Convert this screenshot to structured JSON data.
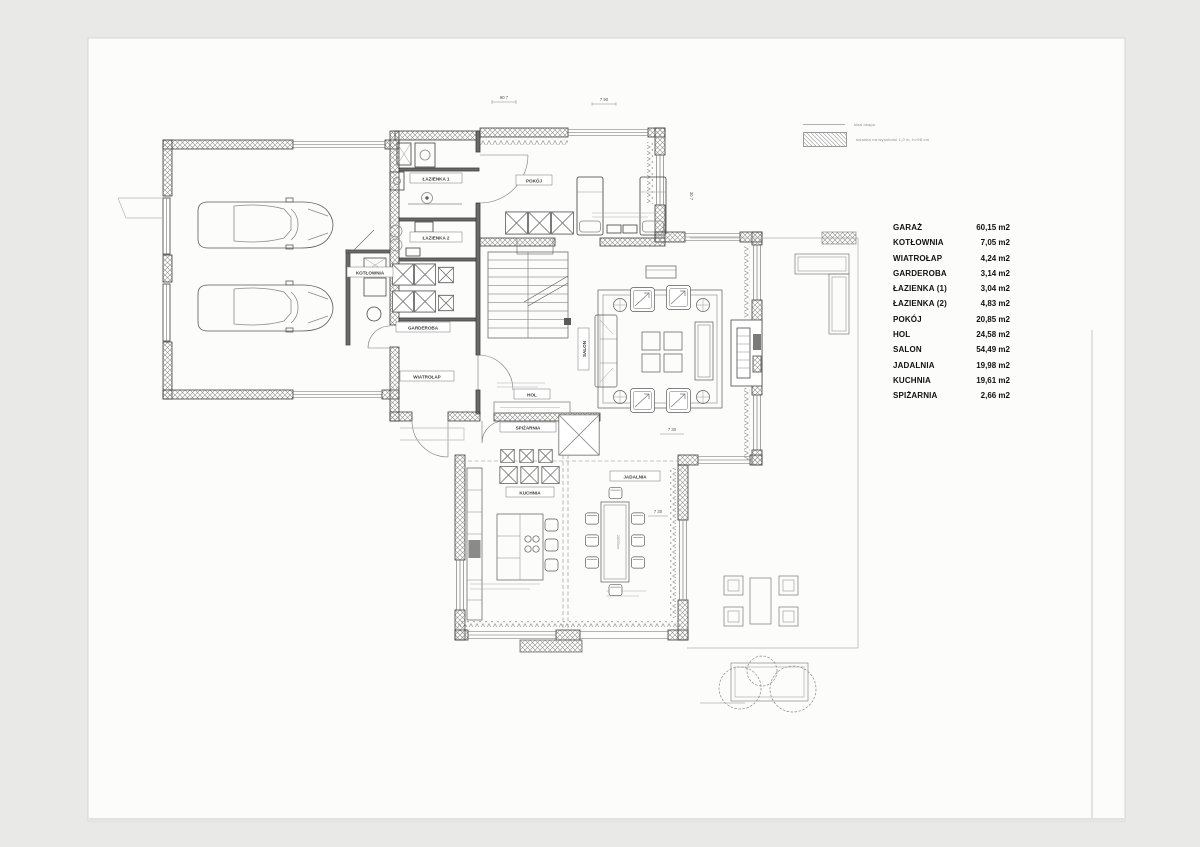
{
  "rooms": [
    {
      "name": "GARAŻ",
      "area": "60,15 m2"
    },
    {
      "name": "KOTŁOWNIA",
      "area": "7,05 m2"
    },
    {
      "name": "WIATROŁAP",
      "area": "4,24 m2"
    },
    {
      "name": "GARDEROBA",
      "area": "3,14 m2"
    },
    {
      "name": "ŁAZIENKA (1)",
      "area": "3,04 m2"
    },
    {
      "name": "ŁAZIENKA (2)",
      "area": "4,83 m2"
    },
    {
      "name": "POKÓJ",
      "area": "20,85 m2"
    },
    {
      "name": "HOL",
      "area": "24,58 m2"
    },
    {
      "name": "SALON",
      "area": "54,49 m2"
    },
    {
      "name": "JADALNIA",
      "area": "19,98 m2"
    },
    {
      "name": "KUCHNIA",
      "area": "19,61 m2"
    },
    {
      "name": "SPIŻARNIA",
      "area": "2,66 m2"
    }
  ],
  "legend": {
    "items": [
      {
        "label": "ślad okapu"
      },
      {
        "label": "ścianka na wysokość 1,0 m, h=98 cm"
      }
    ]
  },
  "plan_labels": {
    "kotlownia": "KOTŁOWNIA",
    "lazienka1": "ŁAZIENKA 1",
    "lazienka2": "ŁAZIENKA 2",
    "garderoba": "GARDEROBA",
    "pokoj": "POKÓJ",
    "wiatrolap": "WIATROŁAP",
    "hol": "HOL",
    "spizarnia": "SPIŻARNIA",
    "kuchnia": "KUCHNIA",
    "jadalnia": "JADALNIA",
    "salon": "SALON"
  },
  "dims": {
    "top_left": "90 7",
    "top_right": "7 90",
    "pokoj_side": "30 7",
    "salon_bottom": "7 30",
    "kuchnia_side": "7 30",
    "table_size": "240/90cm"
  }
}
